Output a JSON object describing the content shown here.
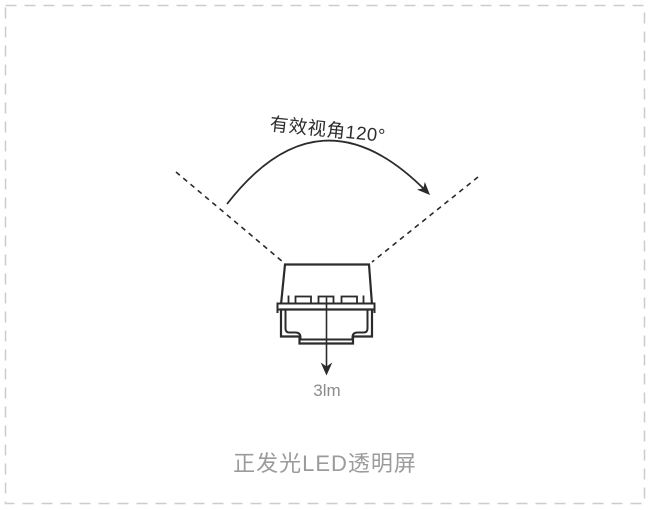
{
  "colors": {
    "background": "#ffffff",
    "line": "#2b2b2b",
    "border": "#cccccc",
    "title_text": "#9b9b9b",
    "lumen_text": "#8b8b8b",
    "label_text": "#2e2e2e"
  },
  "diagram": {
    "viewing_angle_label": "有效视角120°",
    "viewing_angle_value": "120°",
    "luminous_flux_label": "3lm",
    "title": "正发光LED透明屏"
  }
}
